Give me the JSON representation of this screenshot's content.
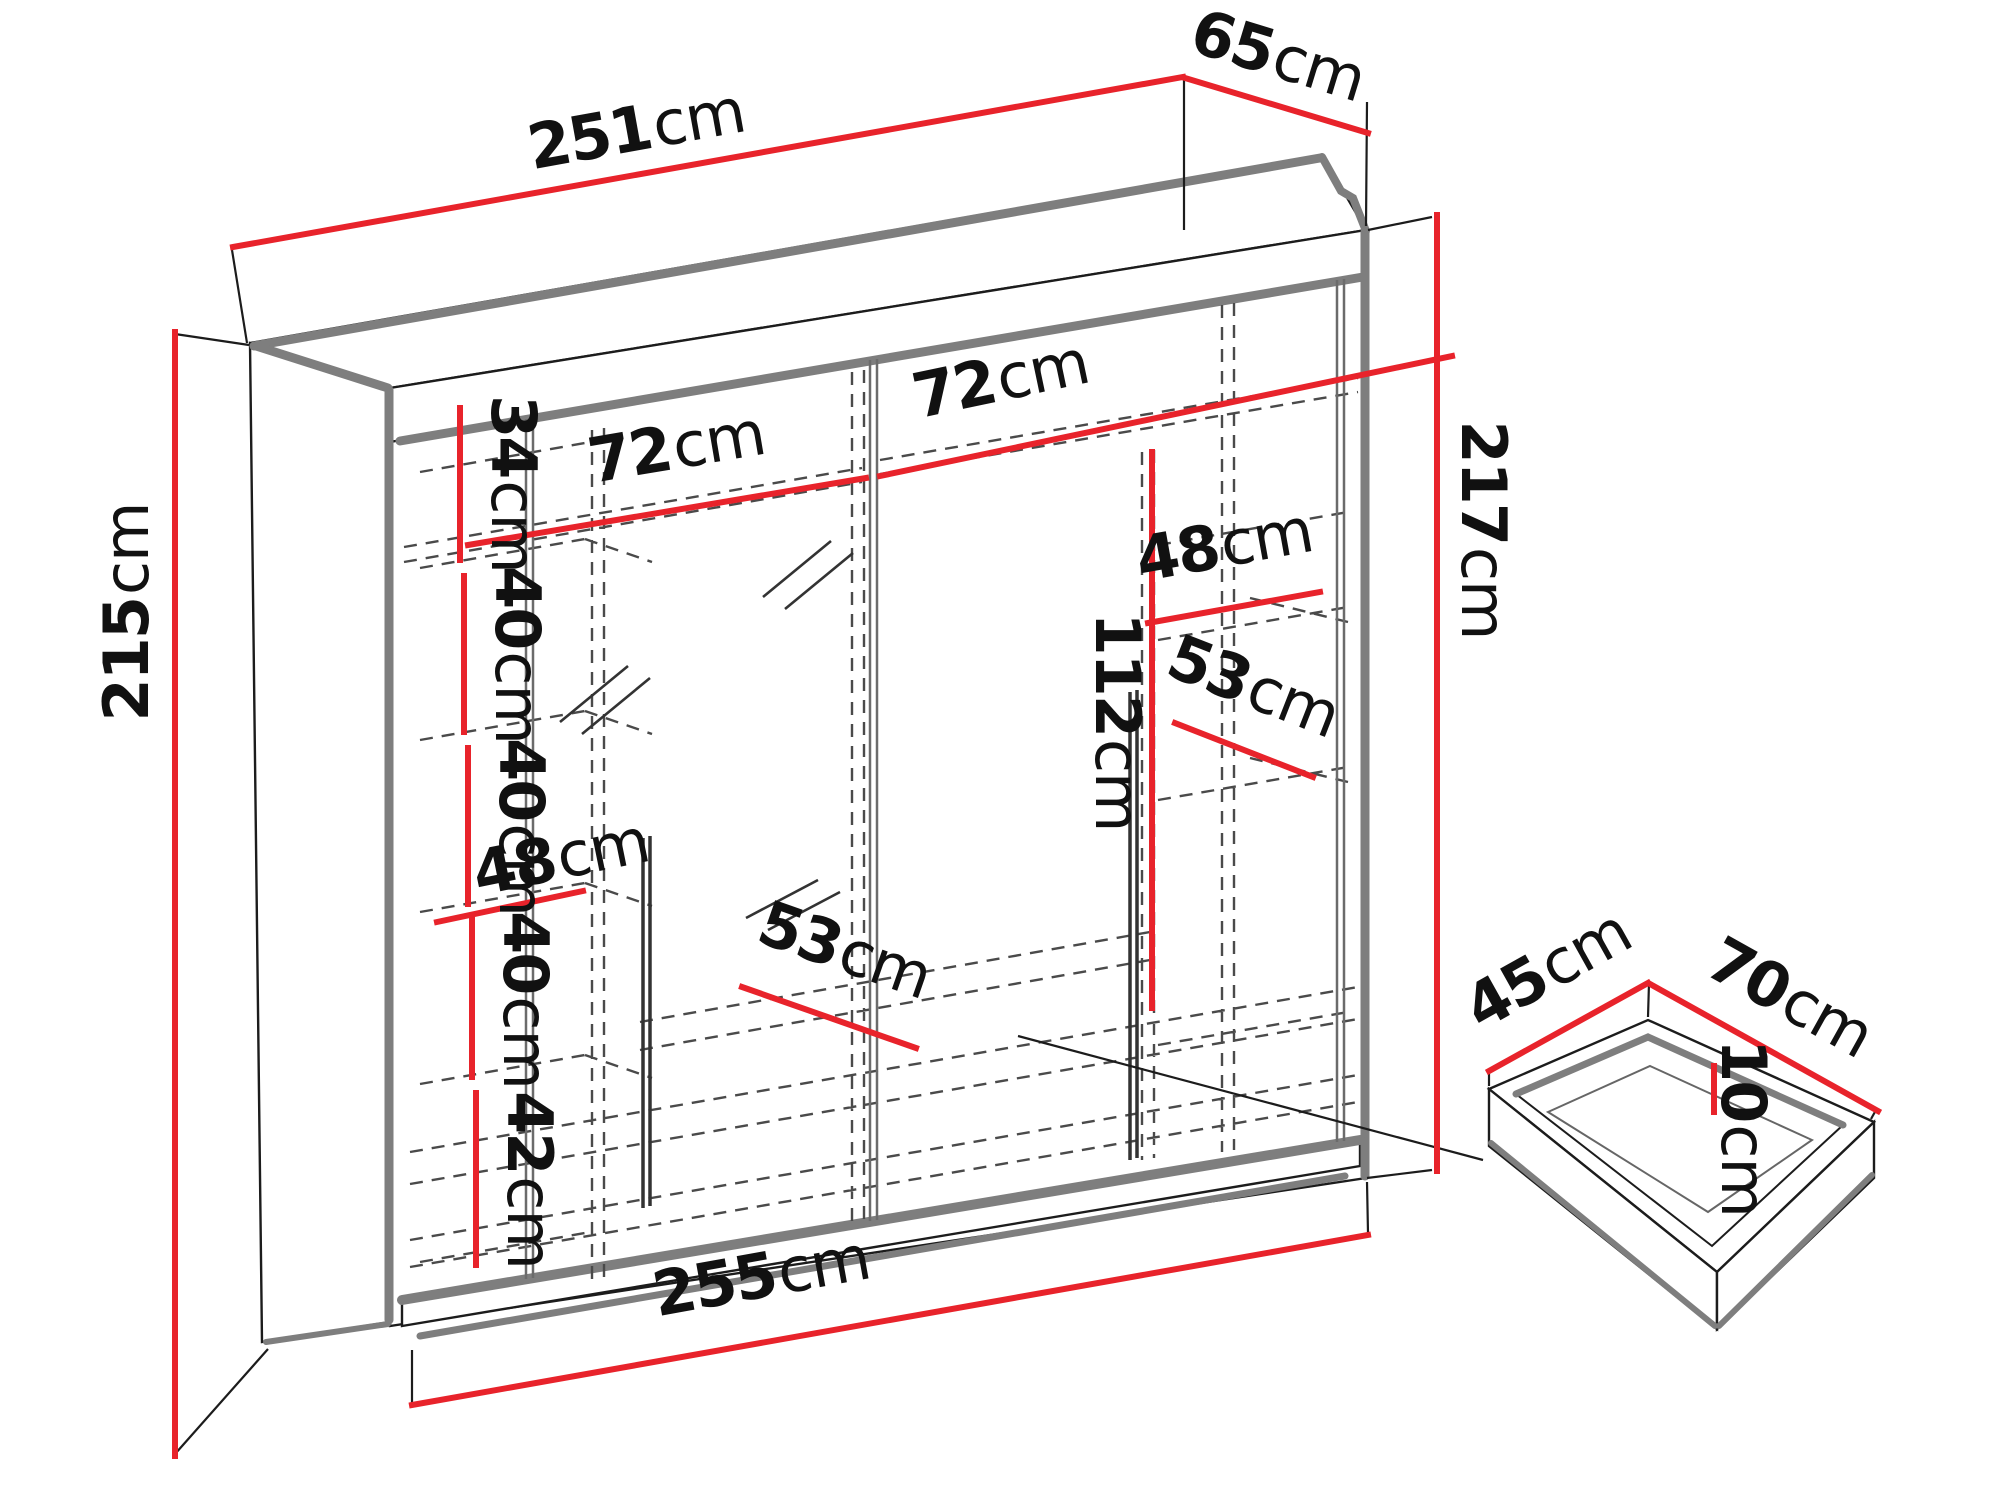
{
  "diagram": {
    "kind": "furniture dimension diagram",
    "subject": "sliding-door wardrobe with interior shelving and under-shelf drawer",
    "unit": "cm",
    "colors": {
      "dimension_red": "#e8232b",
      "outline_black": "#1c1c1c",
      "panel_gray": "#7e7e7e",
      "hidden_dash_gray": "#4a4a4a",
      "background": "#ffffff"
    }
  },
  "dims": {
    "overall": {
      "width_top": {
        "value": "251",
        "unit": "cm"
      },
      "depth_top": {
        "value": "65",
        "unit": "cm"
      },
      "height_left": {
        "value": "215",
        "unit": "cm"
      },
      "height_right": {
        "value": "217",
        "unit": "cm"
      },
      "width_bottom": {
        "value": "255",
        "unit": "cm"
      }
    },
    "interior": {
      "left_section_1_height": {
        "value": "34",
        "unit": "cm"
      },
      "left_section_2_height": {
        "value": "40",
        "unit": "cm"
      },
      "left_section_3_height": {
        "value": "40",
        "unit": "cm"
      },
      "left_shelf_width": {
        "value": "48",
        "unit": "cm"
      },
      "left_section_4_height": {
        "value": "40",
        "unit": "cm"
      },
      "left_section_5_height": {
        "value": "42",
        "unit": "cm"
      },
      "rod_section_left_width": {
        "value": "72",
        "unit": "cm"
      },
      "rod_section_right_width": {
        "value": "72",
        "unit": "cm"
      },
      "hanging_height": {
        "value": "112",
        "unit": "cm"
      },
      "right_shelf_width": {
        "value": "48",
        "unit": "cm"
      },
      "right_shelf_depth": {
        "value": "53",
        "unit": "cm"
      },
      "bottom_shelf_depth": {
        "value": "53",
        "unit": "cm"
      }
    },
    "drawer": {
      "depth": {
        "value": "45",
        "unit": "cm"
      },
      "width": {
        "value": "70",
        "unit": "cm"
      },
      "height": {
        "value": "10",
        "unit": "cm"
      }
    }
  }
}
